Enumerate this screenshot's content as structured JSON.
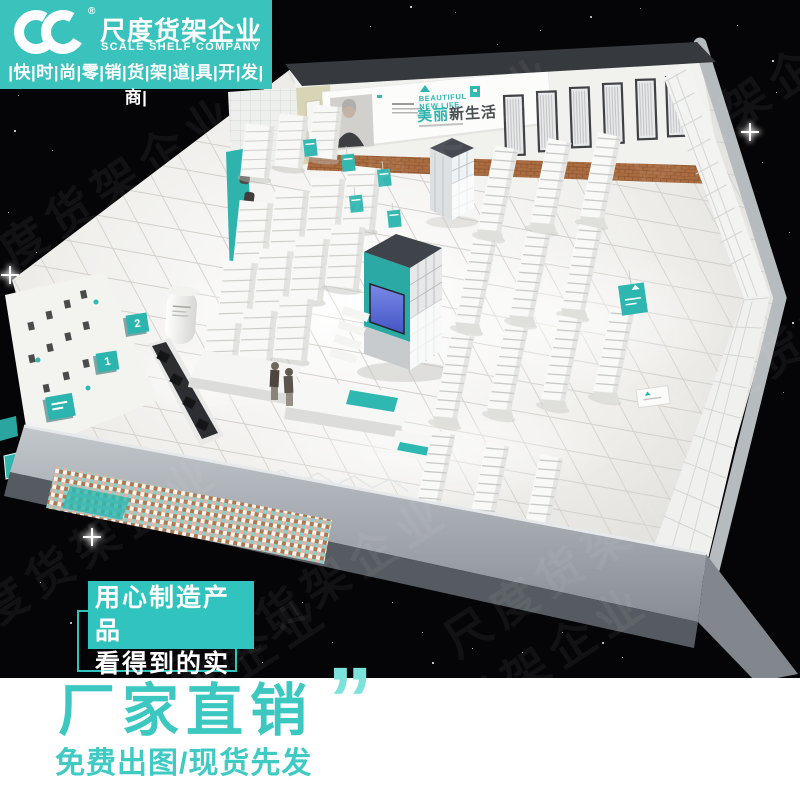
{
  "brand": {
    "logo_icon": "double-c-monogram",
    "reg_mark": "®",
    "company_cn": "尺度货架企业",
    "company_en": "SCALE SHELF COMPANY",
    "tagline": "|快|时|尚|零|销|货|架|道|具|开|发|商|",
    "accent_color": "#3ac3bd"
  },
  "watermark": {
    "text": "尺度货架企业"
  },
  "store": {
    "banner": {
      "en1": "BEAUTIFUL",
      "en2": "NEW LIFE",
      "cn_accent": "美丽",
      "cn_rest": "新生活"
    },
    "queue_signs": [
      "2",
      "1"
    ],
    "accent_color": "#2fb8b2"
  },
  "overlay": {
    "line1": "用心制造产品",
    "line2": "看得到的实力",
    "box_color": "#31c4be"
  },
  "footer": {
    "headline": "厂家直销",
    "quote": "”",
    "subline": "免费出图/现货先发",
    "text_color": "#3cc8c1",
    "quote_color": "#7de2dc"
  }
}
